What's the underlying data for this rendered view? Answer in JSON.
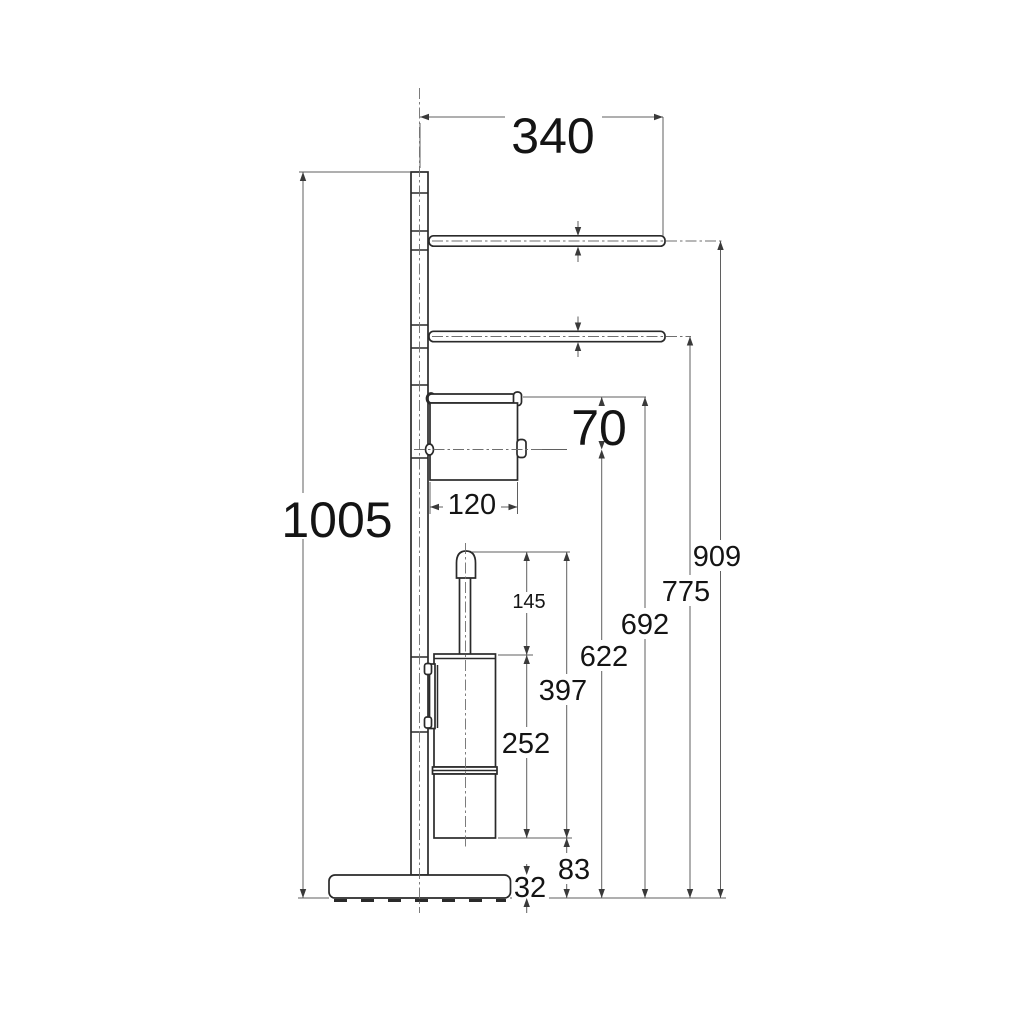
{
  "meta": {
    "background_color": "#ffffff",
    "object_line_color": "#2a2a2a",
    "dimension_line_color": "#5f5f5f",
    "text_color": "#141414",
    "drawing_subject": "free-standing bathroom column with two towel bars, toilet-paper holder and toilet-brush holder"
  },
  "dimensions": {
    "bar_length": "340",
    "total_height": "1005",
    "paper_holder_offset": "70",
    "paper_holder_width": "120",
    "towel_bar_top_height": "909",
    "towel_bar_lower_height": "775",
    "paper_holder_top_height": "692",
    "paper_holder_axis_height": "622",
    "brush_top_to_container_bottom": "397",
    "brush_container_height": "252",
    "brush_handle_exposed_length": "145",
    "container_bottom_clearance": "83",
    "base_plate_thickness": "32"
  }
}
